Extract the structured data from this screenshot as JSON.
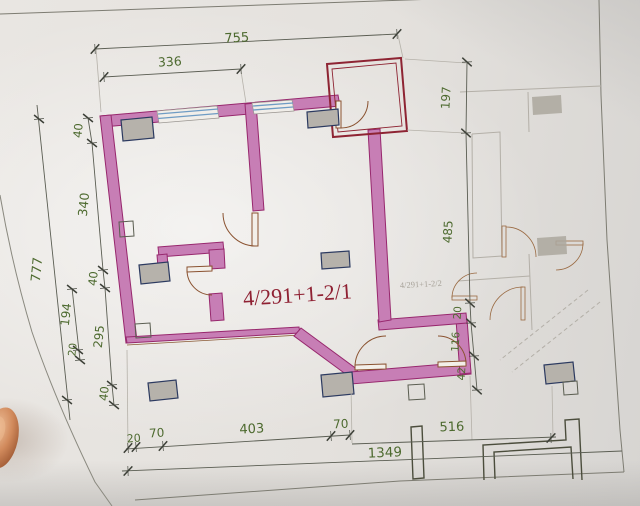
{
  "labels": {
    "main_unit": "4/291+1-2/1",
    "adjacent_unit": "4/291+1-2/2"
  },
  "dims": {
    "top_755": "755",
    "top_336": "336",
    "right_197": "197",
    "right_485": "485",
    "right_20": "20",
    "right_116": "116",
    "right_42": "42",
    "left_777": "777",
    "left_40_top": "40",
    "left_340": "340",
    "left_40_mid": "40",
    "left_194": "194",
    "left_20": "20",
    "left_295": "295",
    "left_40_bottom": "40",
    "bottom_20": "20",
    "bottom_70_left": "70",
    "bottom_403": "403",
    "bottom_70_right": "70",
    "bottom_516": "516",
    "bottom_1349": "1349"
  },
  "colors": {
    "wall_fill": "#c77eb5",
    "wall_edge": "#97276d",
    "balcony_outline": "#8e2433",
    "dimension_text": "#4d6a2f",
    "dimension_line": "#5a5d52",
    "unit_label_text": "#8f2133",
    "adjacent_label_text": "#a8a39a",
    "window": "#6f9cc4",
    "door": "#8a5230",
    "column_fill": "#b6b2ab",
    "column_outline": "#2c3a60",
    "paper": "#e6e3df"
  }
}
